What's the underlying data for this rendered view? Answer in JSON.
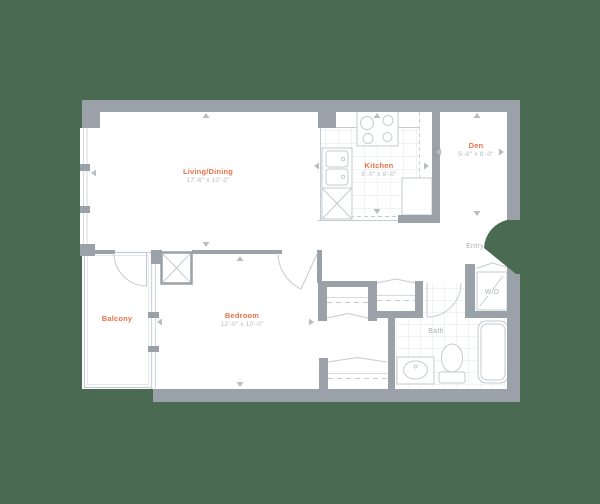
{
  "colors": {
    "bg": "#4a6b51",
    "wall": "#9aa1a9",
    "line": "#c5cbd1",
    "tile": "#e4e7ea",
    "accent": "#e8724c",
    "dim": "#b6bcc3",
    "muted": "#a9afb7",
    "floor": "#ffffff"
  },
  "rooms": [
    {
      "name": "Living/Dining",
      "dims": "17'-6\" x 10'-2\""
    },
    {
      "name": "Kitchen",
      "dims": "8'-0\" x 8'-0\""
    },
    {
      "name": "Den",
      "dims": "5'-8\" x 8'-0\""
    },
    {
      "name": "Bedroom",
      "dims": "12'-0\" x 10'-0\""
    },
    {
      "name": "Balcony"
    }
  ],
  "areas": [
    {
      "label": "Entry"
    },
    {
      "label": "Bath"
    },
    {
      "label": "W/D"
    }
  ]
}
